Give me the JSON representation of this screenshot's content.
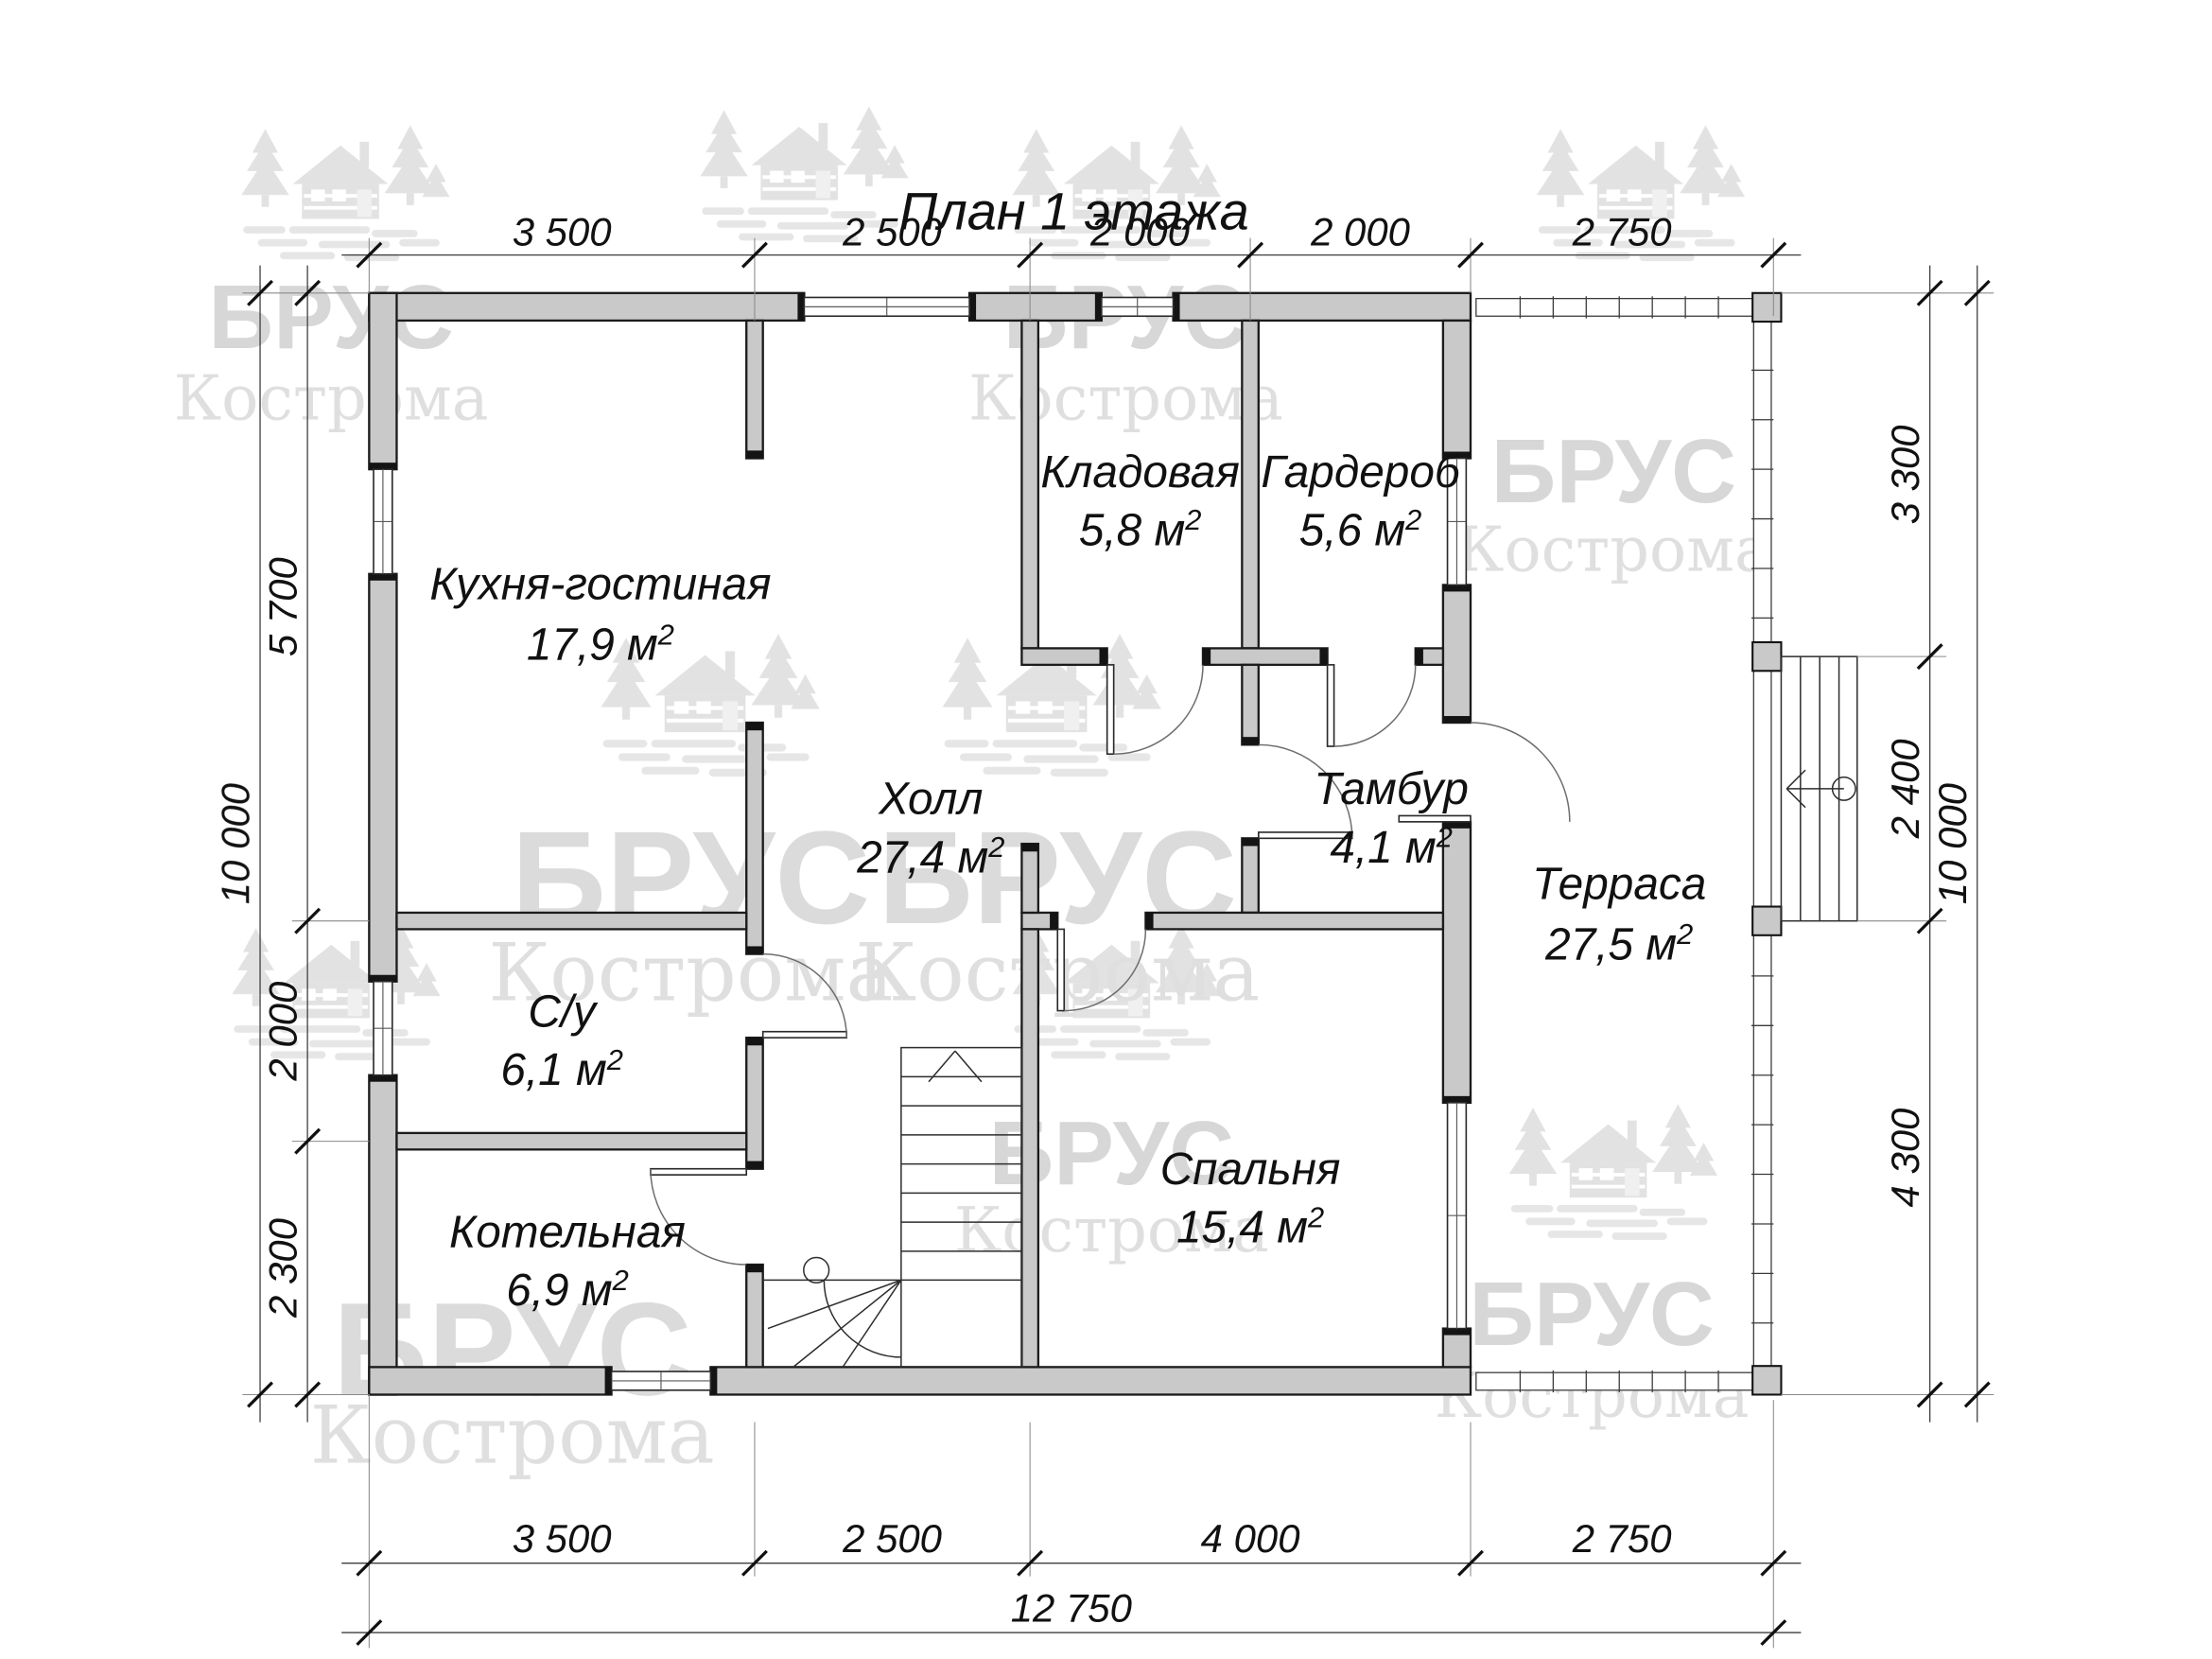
{
  "title": "План 1 этажа",
  "rooms": [
    {
      "name": "Кухня-гостиная",
      "area": "17,9 м",
      "sup": "2"
    },
    {
      "name": "Кладовая",
      "area": "5,8 м",
      "sup": "2"
    },
    {
      "name": "Гардероб",
      "area": "5,6 м",
      "sup": "2"
    },
    {
      "name": "Холл",
      "area": "27,4 м",
      "sup": "2"
    },
    {
      "name": "Тамбур",
      "area": "4,1 м",
      "sup": "2"
    },
    {
      "name": "Терраса",
      "area": "27,5 м",
      "sup": "2"
    },
    {
      "name": "С/у",
      "area": "6,1 м",
      "sup": "2"
    },
    {
      "name": "Котельная",
      "area": "6,9 м",
      "sup": "2"
    },
    {
      "name": "Спальня",
      "area": "15,4 м",
      "sup": "2"
    }
  ],
  "dimensions": {
    "top": [
      "3 500",
      "2 500",
      "2 000",
      "2 000",
      "2 750"
    ],
    "bottom_inner": [
      "3 500",
      "2 500",
      "4 000",
      "2 750"
    ],
    "bottom_total": "12 750",
    "left_inner": [
      "5 700",
      "2 000",
      "2 300"
    ],
    "left_total": "10 000",
    "right_inner": [
      "3 300",
      "2 400",
      "4 300"
    ],
    "right_total": "10 000"
  },
  "watermark": {
    "brand": "БРУС",
    "city": "Кострома"
  },
  "colors": {
    "wall_fill": "#c9c9c9",
    "line": "#1c1c1c",
    "watermark": "#d3d3d3"
  }
}
